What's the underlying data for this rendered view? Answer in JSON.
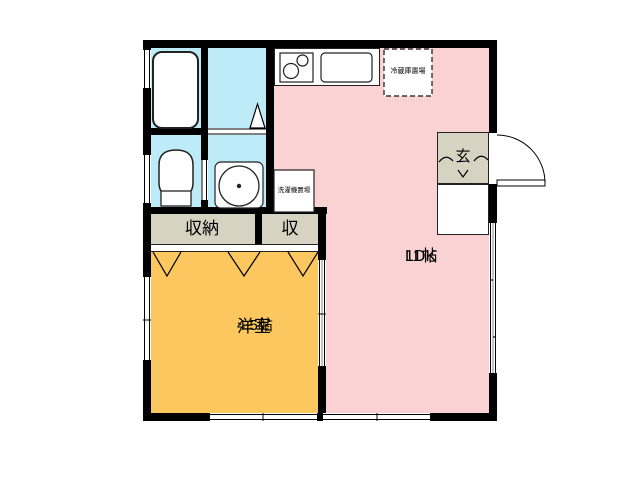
{
  "rooms": {
    "ldk": {
      "name": "LDK",
      "size": "11帖"
    },
    "western": {
      "name": "洋室",
      "size": "4.5帖"
    },
    "closet": {
      "name": "収納"
    },
    "closet_small": {
      "name": "収"
    },
    "entrance": {
      "name": "玄"
    }
  },
  "annotations": {
    "refrigerator": "冷蔵庫置場",
    "washing_machine": "洗濯機置場"
  },
  "colors": {
    "ldk": "#FBD2D3",
    "western": "#FCC75E",
    "wet": "#BEEBF8",
    "storage": "#D6D3C3",
    "wall": "#000000"
  }
}
